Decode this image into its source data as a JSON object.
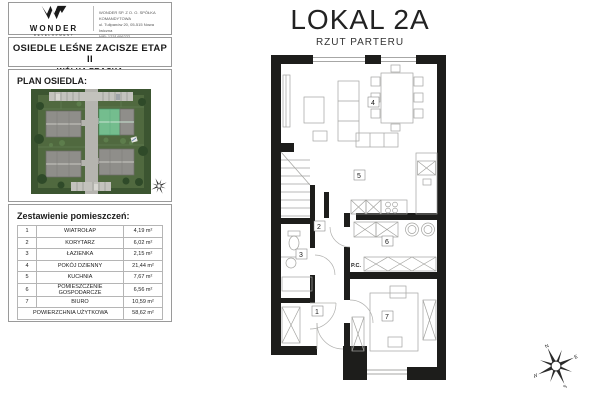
{
  "company": {
    "name": "WONDER",
    "tagline": "DEVELOPMENT",
    "info_line1": "WONDER SP. Z O. O. SPÓŁKA KOMANDYTOWA",
    "info_line2": "ul. Tulipanów 20, 05-515 Nowa Iwiczna",
    "info_line3": "NIP: 1231406222"
  },
  "project": {
    "title": "OSIEDLE LEŚNE ZACISZE ETAP II",
    "subtitle": "WÓLKA PRACKA"
  },
  "site_plan": {
    "label": "PLAN OSIEDLA:"
  },
  "rooms_table": {
    "title": "Zestawienie pomieszczeń:",
    "rows": [
      {
        "no": "1",
        "name": "WIATROŁAP",
        "area": "4,19 m²"
      },
      {
        "no": "2",
        "name": "KORYTARZ",
        "area": "6,02 m²"
      },
      {
        "no": "3",
        "name": "ŁAZIENKA",
        "area": "2,15 m²"
      },
      {
        "no": "4",
        "name": "POKÓJ DZIENNY",
        "area": "21,44 m²"
      },
      {
        "no": "5",
        "name": "KUCHNIA",
        "area": "7,67 m²"
      },
      {
        "no": "6",
        "name": "POMIESZCZENIE GOSPODARCZE",
        "area": "6,56 m²"
      },
      {
        "no": "7",
        "name": "BIURO",
        "area": "10,59 m²"
      }
    ],
    "total": {
      "name": "POWIERZCHNIA UŻYTKOWA",
      "area": "58,62 m²"
    }
  },
  "floor_plan": {
    "title": "LOKAL 2A",
    "subtitle": "RZUT PARTERU",
    "room_numbers": [
      "1",
      "2",
      "3",
      "4",
      "5",
      "6",
      "7"
    ],
    "pc_label": "P.C."
  },
  "compass": {
    "n": "N",
    "e": "E",
    "s": "S",
    "w": "W"
  },
  "colors": {
    "wall": "#1d1d1b",
    "furniture_line": "#a3a3a0",
    "grass": "#50693f",
    "tree_dark": "#2f4a29",
    "roof_gray": "#8f8e8a",
    "highlight_green": "#74bd8e",
    "road": "#b5b4af"
  }
}
